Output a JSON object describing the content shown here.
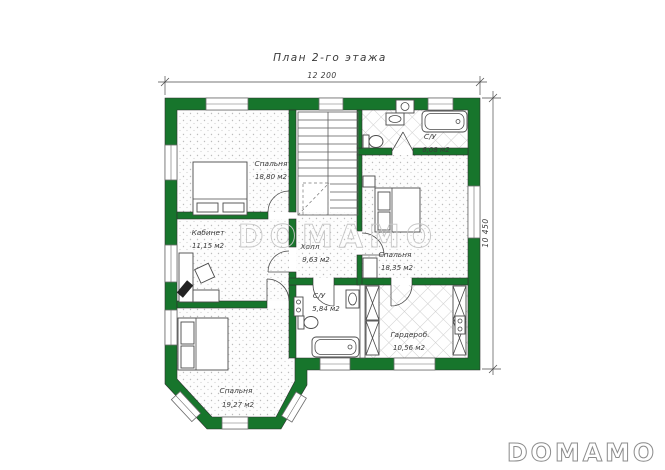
{
  "title": "План 2-го этажа",
  "dimensions": {
    "top": "12 200",
    "right": "10 450"
  },
  "watermarks": {
    "center": "DOMAMO",
    "corner": "DOMAMO"
  },
  "rooms": {
    "bedroom1": {
      "name": "Спальня",
      "area": "18,80 м2"
    },
    "office": {
      "name": "Кабинет",
      "area": "11,15 м2"
    },
    "hall": {
      "name": "Холл",
      "area": "9,63 м2"
    },
    "bedroom2": {
      "name": "Спальня",
      "area": "18,35 м2"
    },
    "bathroom_top": {
      "name": "С/У",
      "area": "6,08 м2"
    },
    "bathroom_mid": {
      "name": "С/У",
      "area": "5,84 м2"
    },
    "wardrobe": {
      "name": "Гардероб.",
      "area": "10,56 м2"
    },
    "bedroom3": {
      "name": "Спальня",
      "area": "19,27 м2"
    }
  },
  "colors": {
    "wall": "#17752c",
    "text": "#3a3a3a",
    "watermark_center": "#c6c6c6",
    "watermark_corner": "#8c8c8c"
  }
}
